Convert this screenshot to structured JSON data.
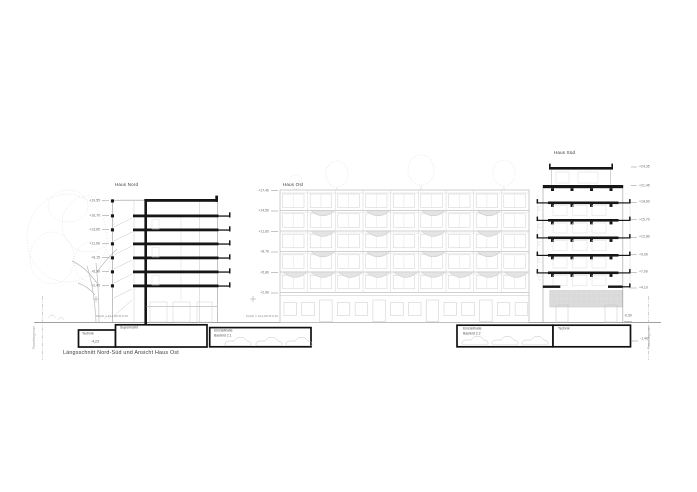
{
  "caption": "Längsschnitt Nord-Süd und Ansicht Haus Ost",
  "haus_nord": {
    "label": "Haus Nord",
    "levels": [
      "+19,55",
      "+16,70",
      "+13,85",
      "+11,00",
      "+8,15",
      "+5,30",
      "+2,45"
    ]
  },
  "haus_ost": {
    "label": "Haus Ost",
    "levels": [
      "+17,40",
      "+14,50",
      "+11,60",
      "+8,70",
      "+5,80",
      "+2,90"
    ]
  },
  "haus_sued": {
    "label": "Haus Süd",
    "levels": [
      "+24,35",
      "+21,45",
      "+18,60",
      "+15,70",
      "+12,80",
      "+9,90",
      "+7,00",
      "+4,10"
    ],
    "sub_levels": [
      "-0,50",
      "-1,40"
    ]
  },
  "basement": {
    "technik_left": "Technik",
    "technik_left_level": "-4,23",
    "supermarkt": "Supermarkt",
    "garage_left_line1": "Einstellhalle",
    "garage_left_line2": "Baufeld 2.1",
    "garage_right_line1": "Einstellhalle",
    "garage_right_line2": "Baufeld 2.2",
    "technik_right": "Technik"
  },
  "ground": {
    "datum": "±0,00 = 413,60 m ü.M."
  },
  "boundaries": {
    "left": "Parzellengrenze",
    "right": "Parzellengrenze"
  },
  "colors": {
    "section_black": "#161616",
    "elevation_gray": "#c8c8c8",
    "ground_gray": "#a0a0a0",
    "block_fill": "#dcdcdc",
    "text_dark": "#444444",
    "text_light": "#777777"
  }
}
